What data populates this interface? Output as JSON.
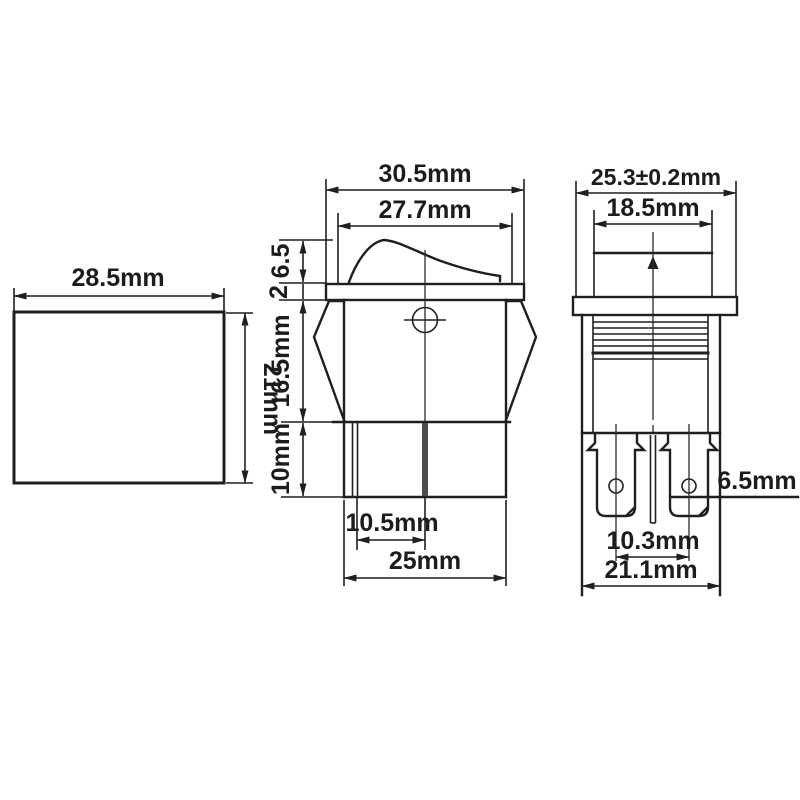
{
  "title": "rocker-switch-dimension-drawing",
  "colors": {
    "ink": "#1f1f1f",
    "background": "#ffffff",
    "terminal_bar": "#4d4d4d"
  },
  "units": "mm",
  "views": {
    "panel_cutout": {
      "width_label": "28.5mm",
      "height_label": "21mm"
    },
    "front": {
      "overall_width_label": "30.5mm",
      "rocker_width_label": "27.7mm",
      "rocker_height_label": "6.5",
      "flange_thickness_label": "2",
      "upper_body_height_label": "16.5mm",
      "lower_body_height_label": "10mm",
      "terminal_pitch_label": "10.5mm",
      "body_width_label": "25mm"
    },
    "side": {
      "overall_width_label": "25.3±0.2mm",
      "rocker_width_label": "18.5mm",
      "terminal_width_label": "6.5mm",
      "terminal_pitch_label": "10.3mm",
      "body_width_label": "21.1mm"
    }
  }
}
